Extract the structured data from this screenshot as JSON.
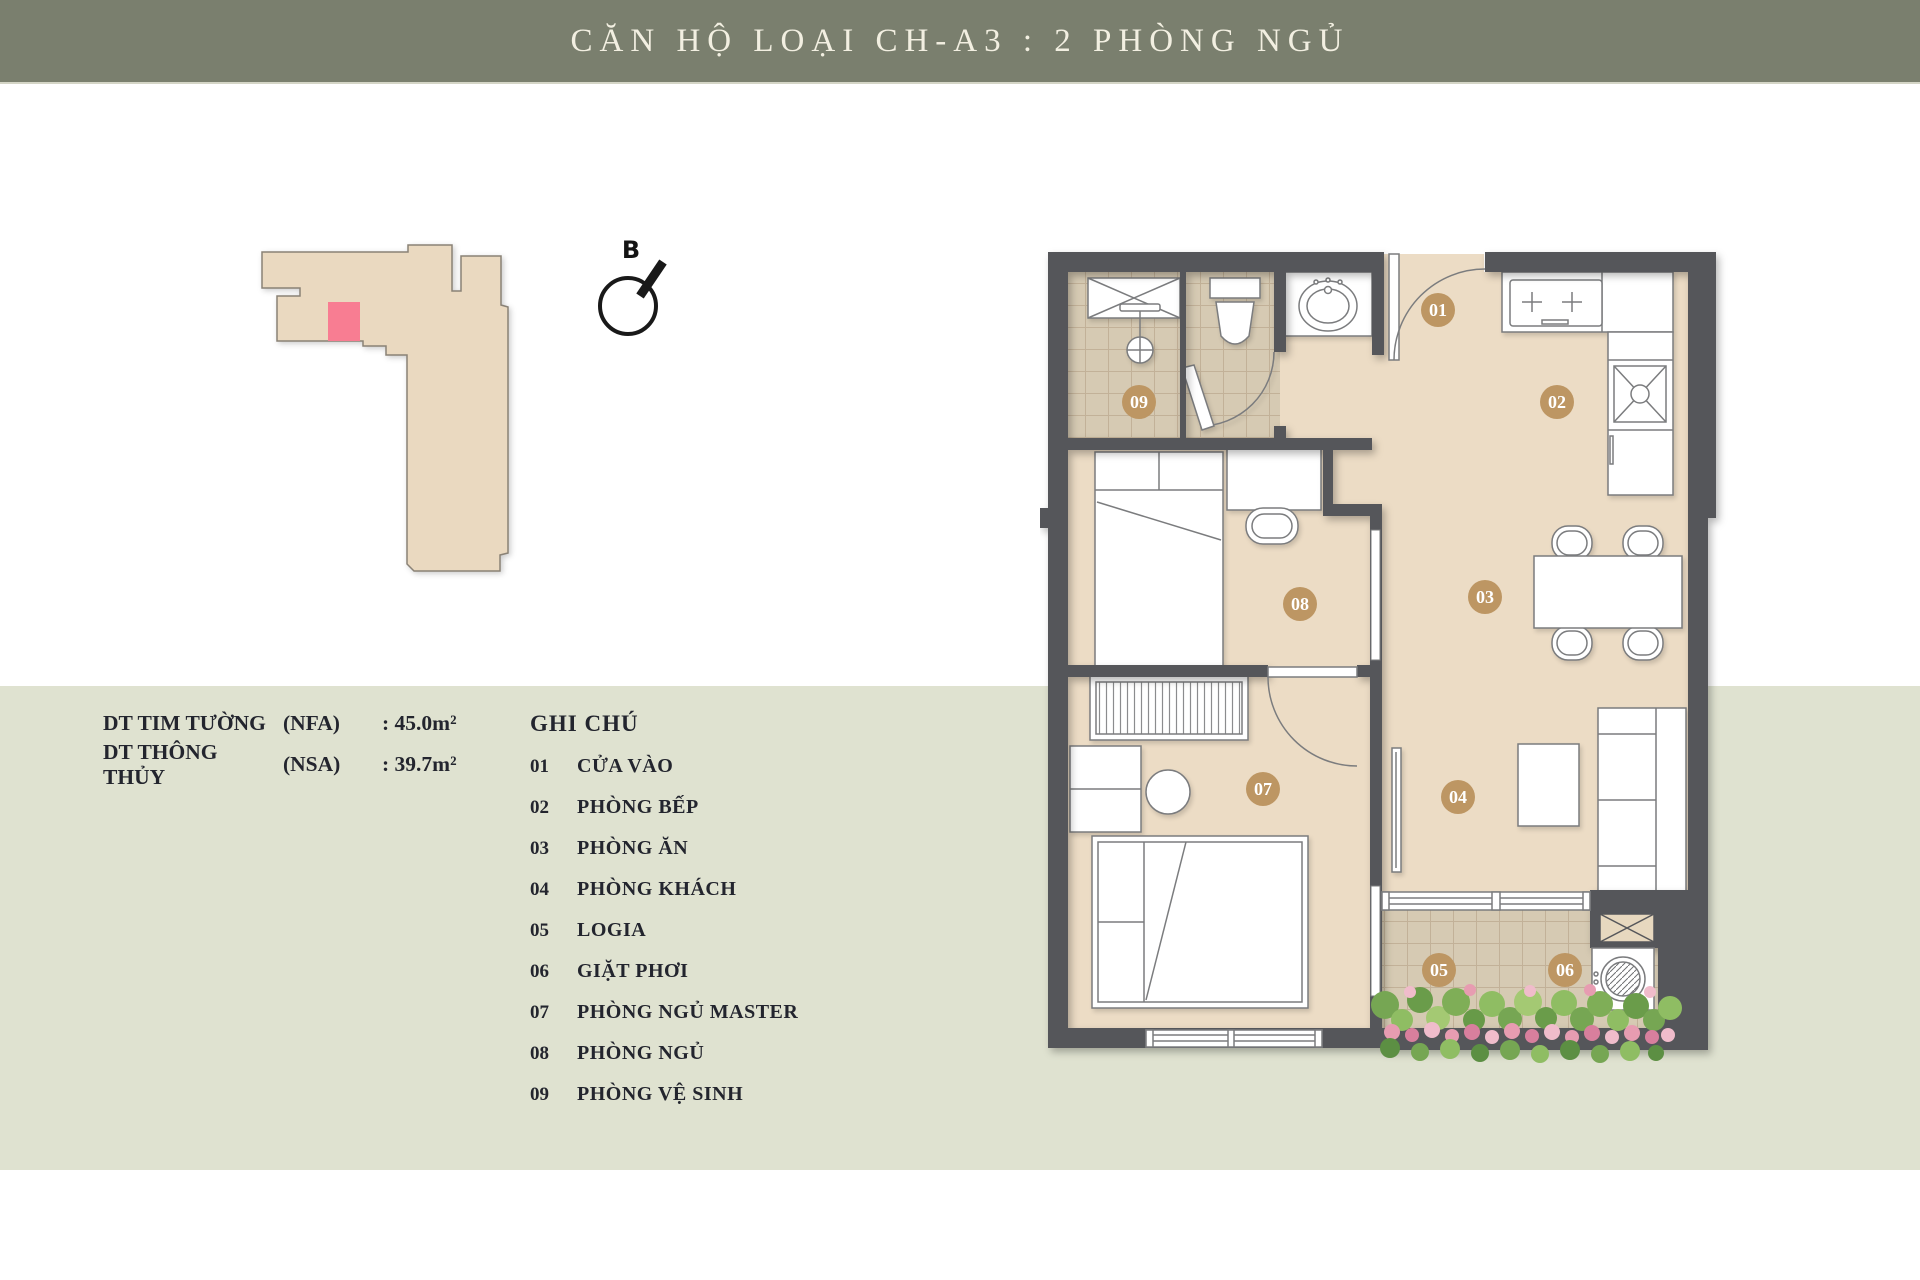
{
  "title": "CĂN HỘ LOẠI CH-A3 : 2 PHÒNG NGỦ",
  "compass_label": "B",
  "areas": {
    "rows": [
      {
        "label": "DT TIM TƯỜNG",
        "code": "(NFA)",
        "value": ": 45.0m²"
      },
      {
        "label": "DT THÔNG THỦY",
        "code": "(NSA)",
        "value": ": 39.7m²"
      }
    ]
  },
  "legend": {
    "title": "GHI CHÚ",
    "items": [
      {
        "num": "01",
        "label": "CỬA VÀO"
      },
      {
        "num": "02",
        "label": "PHÒNG BẾP"
      },
      {
        "num": "03",
        "label": "PHÒNG ĂN"
      },
      {
        "num": "04",
        "label": "PHÒNG KHÁCH"
      },
      {
        "num": "05",
        "label": "LOGIA"
      },
      {
        "num": "06",
        "label": "GIẶT PHƠI"
      },
      {
        "num": "07",
        "label": "PHÒNG NGỦ MASTER"
      },
      {
        "num": "08",
        "label": "PHÒNG NGỦ"
      },
      {
        "num": "09",
        "label": "PHÒNG VỆ SINH"
      }
    ]
  },
  "colors": {
    "header_bg": "#7a7f6e",
    "header_text": "#f2efe1",
    "band_bg": "#dfe2d0",
    "wall": "#55565a",
    "floor": "#ecdcc5",
    "tile": "#d6cab3",
    "badge": "#bd9663",
    "keyplan_fill": "#ead9c0",
    "highlight_unit": "#f87d92",
    "text_dark": "#23252e"
  }
}
